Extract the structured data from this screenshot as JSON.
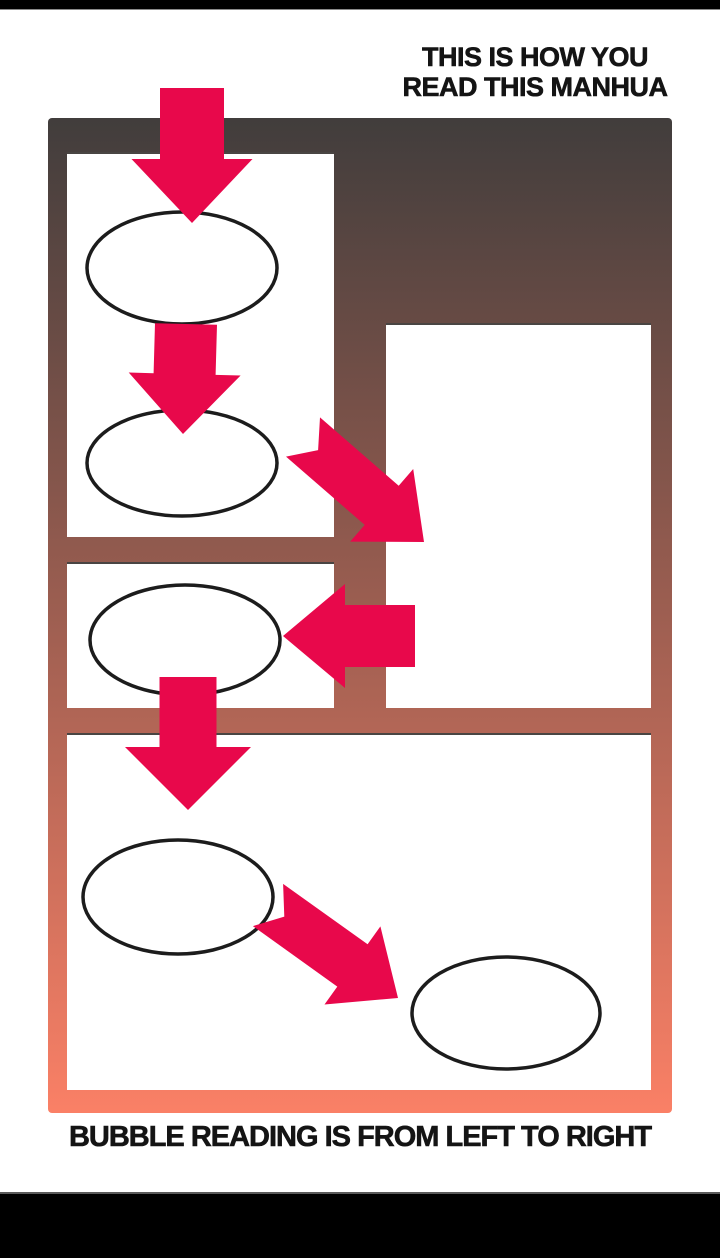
{
  "page": {
    "title_line1": "THIS IS HOW YOU",
    "title_line2": "READ THIS MANHUA",
    "caption": "BUBBLE READING IS FROM LEFT TO RIGHT"
  },
  "colors": {
    "arrow": "#E8084B",
    "gradient_top": "#413D3C",
    "gradient_bottom": "#FA8066",
    "panel_background": "#FFFFFF",
    "bubble_stroke": "#1C1C1C",
    "frame_bar": "#000000",
    "text": "#141414"
  },
  "diagram": {
    "canvas": {
      "width": 720,
      "height": 1258
    },
    "gradient_box": {
      "x": 48,
      "y": 118,
      "w": 624,
      "h": 995
    },
    "panels": [
      {
        "id": "panel-1",
        "x": 67,
        "y": 152,
        "w": 267,
        "h": 385
      },
      {
        "id": "panel-2",
        "x": 386,
        "y": 323,
        "w": 265,
        "h": 385
      },
      {
        "id": "panel-3",
        "x": 67,
        "y": 562,
        "w": 267,
        "h": 146
      },
      {
        "id": "panel-4",
        "x": 67,
        "y": 733,
        "w": 584,
        "h": 357
      }
    ],
    "speech_bubbles": [
      {
        "id": "bubble-1",
        "cx": 182,
        "cy": 268,
        "rx": 95,
        "ry": 56
      },
      {
        "id": "bubble-2",
        "cx": 182,
        "cy": 463,
        "rx": 95,
        "ry": 53
      },
      {
        "id": "bubble-3",
        "cx": 185,
        "cy": 640,
        "rx": 95,
        "ry": 55
      },
      {
        "id": "bubble-4",
        "cx": 178,
        "cy": 897,
        "rx": 95,
        "ry": 57
      },
      {
        "id": "bubble-5",
        "cx": 506,
        "cy": 1013,
        "rx": 94,
        "ry": 56
      }
    ],
    "arrows": [
      {
        "id": "reading-arrow-1",
        "direction": "down",
        "tail": [
          192,
          88
        ],
        "tip": [
          192,
          223
        ],
        "sw": 64,
        "hw": 121,
        "hl": 64,
        "notch": 0
      },
      {
        "id": "reading-arrow-2",
        "direction": "down",
        "tail": [
          186,
          324
        ],
        "tip": [
          183,
          434
        ],
        "sw": 62,
        "hw": 112,
        "hl": 60,
        "notch": 0
      },
      {
        "id": "reading-arrow-3",
        "direction": "down-right",
        "tail": [
          303,
          437
        ],
        "tip": [
          424,
          542
        ],
        "sw": 52,
        "hw": 96,
        "hl": 56,
        "notch": 20
      },
      {
        "id": "reading-arrow-4",
        "direction": "left",
        "tail": [
          415,
          636
        ],
        "tip": [
          283,
          636
        ],
        "sw": 62,
        "hw": 104,
        "hl": 62,
        "notch": 0
      },
      {
        "id": "reading-arrow-5",
        "direction": "down",
        "tail": [
          188,
          677
        ],
        "tip": [
          188,
          810
        ],
        "sw": 57,
        "hw": 126,
        "hl": 63,
        "notch": 0
      },
      {
        "id": "reading-arrow-6",
        "direction": "down-right",
        "tail": [
          268,
          905
        ],
        "tip": [
          398,
          998
        ],
        "sw": 52,
        "hw": 96,
        "hl": 56,
        "notch": 20
      }
    ]
  }
}
